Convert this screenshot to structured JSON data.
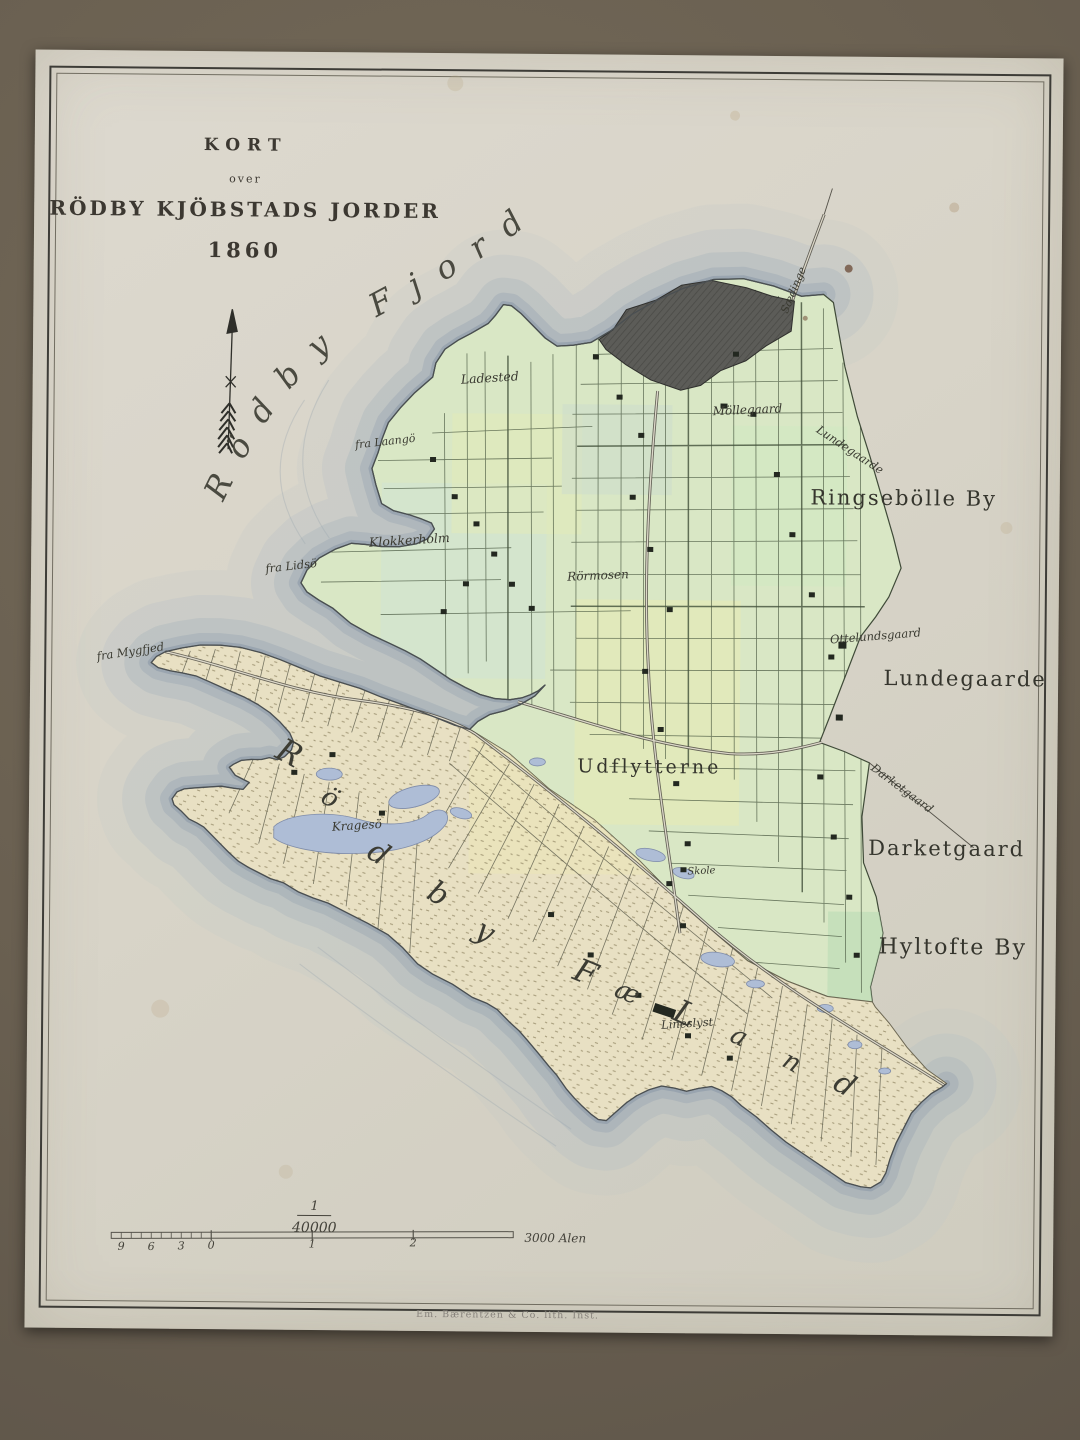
{
  "title": {
    "kicker": "KORT",
    "over": "over",
    "main": "RÖDBY KJÖBSTADS JORDER",
    "year": "1860"
  },
  "map": {
    "fjord_label": "Rödby Fjord",
    "labels": {
      "ladested": "Ladested",
      "fra_laangoe": "fra Laangö",
      "klokkerholm": "Klokkerholm",
      "fra_lidsoe": "fra Lidsö",
      "fra_mygfjed": "fra Mygfjed",
      "moellegaard": "Möllegaard",
      "saedinge": "Sædinge",
      "lundegaarde_boundary": "Lundegaarde",
      "ringseboelle_by": "Ringsebölle By",
      "roermosen": "Rörmosen",
      "ottelundsgaard": "Ottelundsgaard",
      "lundegaarde": "Lundegaarde",
      "udflytterne": "Udflytterne",
      "darketgaard_boundary": "Darketgaard",
      "darketgaard": "Darketgaard",
      "hyltofte_by": "Hyltofte By",
      "kragesoe": "Kragesö",
      "skole": "Skole",
      "lineslyst": "Lineslyst"
    },
    "peninsula_letters": [
      {
        "ch": "R",
        "x": 260,
        "y": 701,
        "rot": 28,
        "size": 32
      },
      {
        "ch": "ö",
        "x": 301,
        "y": 746,
        "rot": 30,
        "size": 26
      },
      {
        "ch": "d",
        "x": 350,
        "y": 801,
        "rot": 32,
        "size": 30
      },
      {
        "ch": "b",
        "x": 410,
        "y": 841,
        "rot": 30,
        "size": 30
      },
      {
        "ch": "y",
        "x": 457,
        "y": 878,
        "rot": 30,
        "size": 30
      },
      {
        "ch": "F",
        "x": 558,
        "y": 918,
        "rot": 22,
        "size": 32
      },
      {
        "ch": "æ",
        "x": 600,
        "y": 938,
        "rot": 22,
        "size": 26
      },
      {
        "ch": "L",
        "x": 658,
        "y": 958,
        "rot": 24,
        "size": 32
      },
      {
        "ch": "a",
        "x": 712,
        "y": 981,
        "rot": 26,
        "size": 26
      },
      {
        "ch": "n",
        "x": 765,
        "y": 1006,
        "rot": 28,
        "size": 26
      },
      {
        "ch": "d",
        "x": 818,
        "y": 1028,
        "rot": 30,
        "size": 30
      }
    ],
    "icons": {
      "north_arrow": "feathered-north-arrow"
    }
  },
  "scale": {
    "numerator": "1",
    "denominator": "40000",
    "ticks": [
      "9",
      "6",
      "3",
      "0",
      "1",
      "2"
    ],
    "unit": "3000 Alen"
  },
  "imprint": "Em. Bærentzen & Co. lith. Inst.",
  "colors": {
    "frame_brown": "#746a59",
    "paper": "#d8d4c8",
    "field_green": "#d9e7c5",
    "meadow_tan": "#e8e0c3",
    "town_gray": "#5c5c58",
    "lake_blue": "#aebdd6",
    "sea_band": "#9fabb6",
    "ink": "#3a3a31"
  }
}
